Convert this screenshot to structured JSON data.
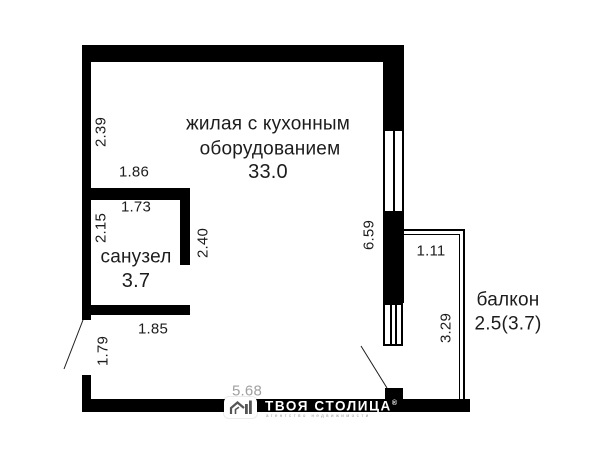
{
  "floor_plan": {
    "living_room": {
      "label_line1": "жилая с кухонным",
      "label_line2": "оборудованием",
      "area": "33.0"
    },
    "bathroom": {
      "label": "санузел",
      "area": "3.7"
    },
    "balcony": {
      "label": "балкон",
      "area": "2.5(3.7)"
    },
    "dimensions": {
      "living_left_height": "2.39",
      "bathroom_top_width": "1.86",
      "bathroom_inner_width": "1.73",
      "bathroom_inner_height": "2.15",
      "bathroom_right_height": "2.40",
      "bathroom_bottom_width": "1.85",
      "entry_wall_height": "1.79",
      "bottom_wall_width": "5.68",
      "right_wall_height": "6.59",
      "balcony_top_width": "1.11",
      "balcony_right_height": "3.29"
    }
  },
  "watermark": {
    "brand": "ТВОЯ СТОЛИЦА",
    "reg": "®",
    "tagline": "агентство недвижимости"
  },
  "colors": {
    "wall": "#000000",
    "text": "#1c1c1c",
    "muted_dimension": "#a0a0a0",
    "watermark_text": "#ffffff"
  }
}
